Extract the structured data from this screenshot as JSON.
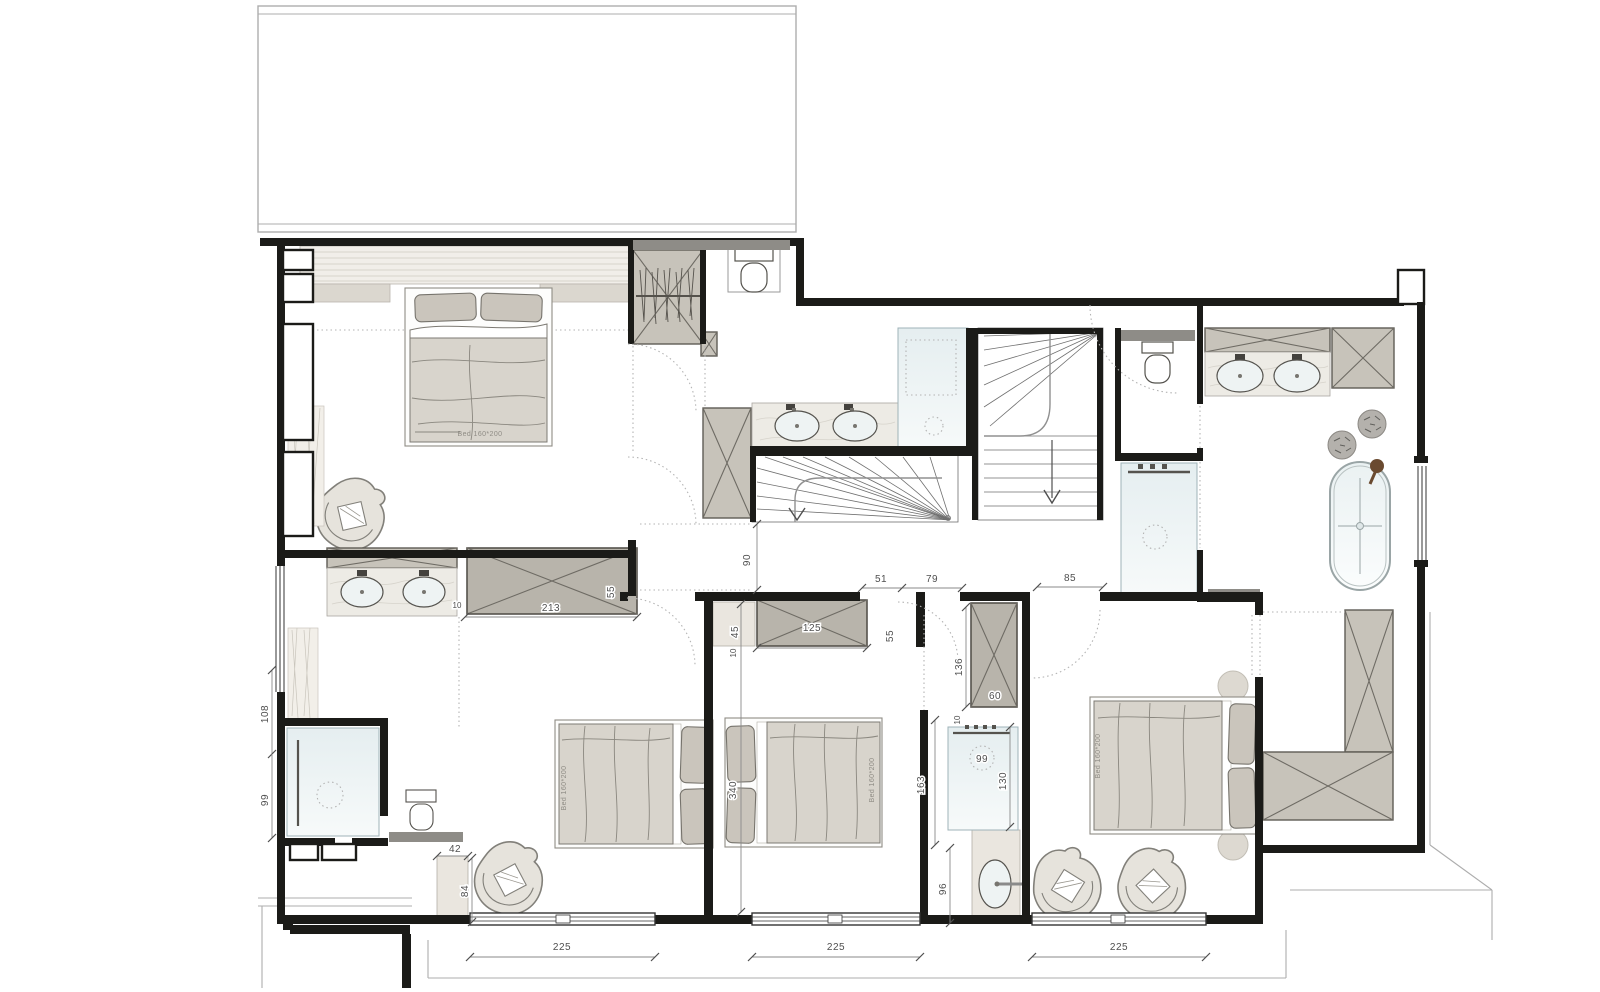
{
  "plan": {
    "bed_label": "Bed 160*200",
    "dims": {
      "win1": "225",
      "win2": "225",
      "win3": "225",
      "wardrobe213": "213",
      "gap10a": "10",
      "depth55a": "55",
      "left108": "108",
      "left99": "99",
      "niche42": "42",
      "niche84": "84",
      "hall90": "90",
      "seg51": "51",
      "seg79": "79",
      "landing85": "85",
      "wardrobe125": "125",
      "niche45": "45",
      "gap10b": "10",
      "depth55b": "55",
      "wardrobe136": "136",
      "wardrobe60": "60",
      "gap10c": "10",
      "shower99": "99",
      "shower130": "130",
      "shower163": "163",
      "sink96": "96",
      "room340": "340"
    }
  }
}
